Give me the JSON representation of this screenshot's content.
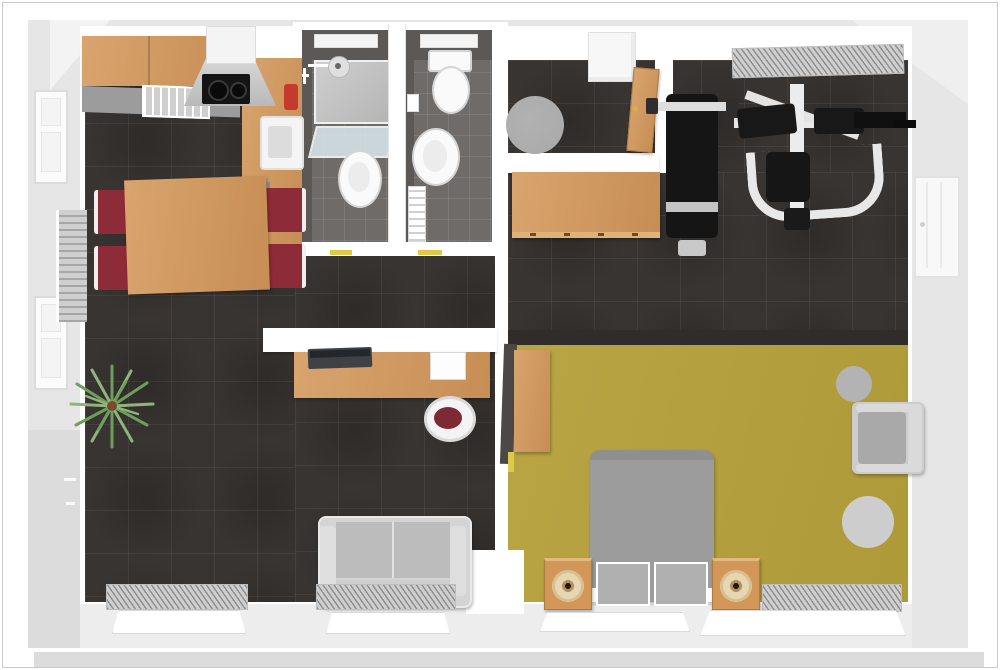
{
  "image": {
    "description": "3D top-down rendered floor plan of an apartment with kitchen-dining room, two bathrooms, entry hallway, fitness room, bedroom and living area",
    "width_px": 1000,
    "height_px": 670,
    "visible_text": ""
  },
  "palette": {
    "canvas_bg": "#ffffff",
    "frame_border": "#c9c9c9",
    "outer_wall": "#e6e6e6",
    "outer_wall_dark": "#dcdcdc",
    "inner_wall": "#ffffff",
    "floor_dark": "#383431",
    "floor_yellow": "#b5a03a",
    "bath_floor": "#6f6b68",
    "bath_wall": "#5c5856",
    "wood": "#d3975a",
    "wood_dark": "#b97f41",
    "counter_gray": "#9c9c9c",
    "hood_gray": "#c6c6c6",
    "appliance_black": "#141414",
    "appliance_red": "#c43b2e",
    "chair_red": "#8e2b38",
    "sofa_light": "#d4d4d4",
    "sofa_seat": "#bcbcbc",
    "bed_gray": "#9c9c9c",
    "bed_foot": "#b0b0b0",
    "rug_gray": "#a8a8a8",
    "radiator_face": "#cfcfcf",
    "radiator_line": "#8f8f8f",
    "plant_green": "#6f9d5c",
    "plant_green_light": "#8fb57d",
    "plant_pot": "#7b4a2d",
    "fixture_white": "#fafafa",
    "glass_blue": "#dce9ee",
    "gym_black": "#151515",
    "gym_frame": "#e8e8e8",
    "shadow_wall": "#2f2c2a",
    "threshold_yellow": "#e0c84b"
  },
  "rooms": {
    "kitchen_dining": {
      "name": "Kitchen and dining area (dark tile floor)"
    },
    "living": {
      "name": "Living / office area (dark tile floor)"
    },
    "bath_left": {
      "name": "Bathroom with shower"
    },
    "bath_right": {
      "name": "Bathroom with WC"
    },
    "hallway": {
      "name": "Entry hallway"
    },
    "gym": {
      "name": "Fitness room (dark tile floor)"
    },
    "bedroom": {
      "name": "Bedroom (yellow floor)"
    }
  },
  "furniture": {
    "kitchen_cabinets": "Kitchen cabinet run",
    "range_hood": "Extractor hood",
    "cooktop": "Black cooktop with two burners",
    "dish_rack": "Dish rack on counter",
    "kitchen_counter": "Kitchen corner counter",
    "kitchen_sink": "Kitchen sink",
    "coffee_machine": "Red countertop appliance",
    "dining_table": "Wooden dining table",
    "dining_chair": "Dining chair with dark red seat",
    "wall_radiator": "Wall radiator",
    "window": "Window",
    "shower": "Shower enclosure",
    "shower_head": "Shower head",
    "glass_shelf": "Glass shower screen",
    "bathroom_sink": "Washbasin",
    "toilet": "Toilet",
    "toilet_paper_holder": "Toilet paper holder",
    "towel_rail": "Towel rail",
    "bathroom_radiator": "Bathroom radiator",
    "hallway_rug": "Round gray rug",
    "shoe_cabinet": "White hallway cabinet",
    "entry_door": "Open wooden entry door",
    "sideboard": "Wooden sideboard",
    "weight_bench": "Black weight bench with barbell",
    "multi_gym": "Multi-gym strength machine",
    "interior_door": "Door in right wall",
    "wardrobe": "Wardrobe with open door",
    "bed": "Gray double bed",
    "speaker": "Wooden loudspeaker",
    "armchair": "Gray armchair",
    "round_rug_small": "Small round rug",
    "round_rug_large": "Large round rug",
    "desk": "Wooden desk",
    "laptop": "Laptop on desk",
    "paper": "Notepad on desk",
    "office_chair": "Office chair",
    "sofa": "Gray sofa",
    "plant": "Potted palm plant",
    "window_sill": "Window sill",
    "door_threshold": "Door threshold",
    "doorway": "Doorway opening",
    "washing_area": "White appliance box"
  }
}
